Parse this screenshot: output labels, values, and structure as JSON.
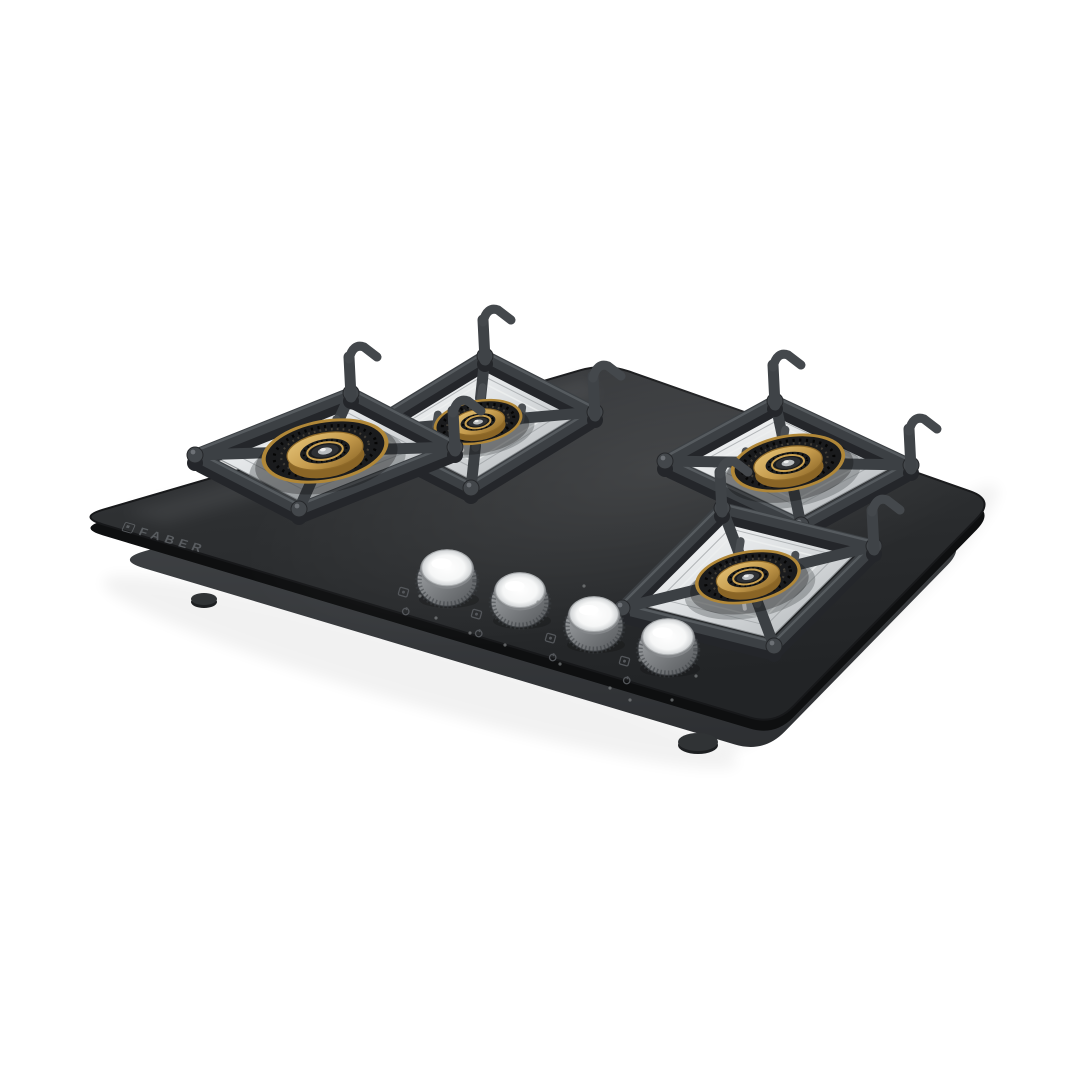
{
  "meta": {
    "type": "product-photo",
    "description": "Built-in 4 burner gas hob, black glass top, brass burners, cast-iron pan supports, stainless steel knobs, angled studio view on white background",
    "background": "#ffffff"
  },
  "brand": {
    "name": "FABER"
  },
  "palette": {
    "glass_dark": "#222426",
    "glass_mid": "#2d2f31",
    "glass_light": "#3a3c3f",
    "glass_edge": "#0e0f10",
    "body_light": "#474a4d",
    "body_dark": "#2d2f32",
    "iron_main": "#3c4044",
    "iron_dark": "#24262a",
    "iron_light": "#5d6166",
    "steel_light": "#fdfdfd",
    "steel_mid": "#dfe2e4",
    "steel_dark": "#aeb2b5",
    "brass_light": "#e6c478",
    "brass_mid": "#c49a4c",
    "brass_dark": "#8a6526",
    "ring_dark": "#1a1b1d",
    "knob_light": "#a6a9ac",
    "knob_dark": "#54575a",
    "knob_top": "#f6f7f7",
    "mark_gray": "#53565a",
    "logo_gray": "#6b6f73"
  },
  "scene": {
    "canvas": {
      "w": 1080,
      "h": 1080
    },
    "glass": {
      "corners": [
        [
          78,
          517
        ],
        [
          605,
          363
        ],
        [
          995,
          500
        ],
        [
          775,
          725
        ]
      ],
      "cornerRadius": 26,
      "thickness": 11
    },
    "body": {
      "scale": 0.93,
      "dy": 42,
      "feet": [
        [
          204,
          599,
          13,
          6
        ],
        [
          698,
          742,
          20,
          9
        ]
      ]
    },
    "burnerTilt": -10,
    "squash": 0.47,
    "modules": [
      {
        "id": "left-large",
        "cx": 325,
        "cy": 451,
        "uh": [
          78,
          -31
        ],
        "vh": [
          52,
          27
        ],
        "r": 60
      },
      {
        "id": "back-middle",
        "cx": 478,
        "cy": 422,
        "uh": [
          62,
          -38
        ],
        "vh": [
          55,
          28
        ],
        "r": 42
      },
      {
        "id": "right-back",
        "cx": 788,
        "cy": 463,
        "uh": [
          55,
          -30
        ],
        "vh": [
          68,
          32
        ],
        "r": 54
      },
      {
        "id": "front-right",
        "cx": 748,
        "cy": 577,
        "uh": [
          50,
          -50
        ],
        "vh": [
          76,
          19
        ],
        "r": 50
      }
    ],
    "knobs": [
      [
        447,
        578,
        30
      ],
      [
        520,
        600,
        29
      ],
      [
        594,
        624,
        29
      ],
      [
        668,
        647,
        30
      ]
    ],
    "specks": [
      [
        436,
        618
      ],
      [
        470,
        633
      ],
      [
        505,
        645
      ],
      [
        538,
        602
      ],
      [
        560,
        664
      ],
      [
        610,
        688
      ],
      [
        640,
        660
      ],
      [
        672,
        700
      ],
      [
        696,
        676
      ],
      [
        420,
        596
      ],
      [
        584,
        586
      ],
      [
        630,
        700
      ]
    ],
    "logo": {
      "x": 126,
      "y": 520,
      "rotate": 16,
      "skew": -8
    }
  }
}
